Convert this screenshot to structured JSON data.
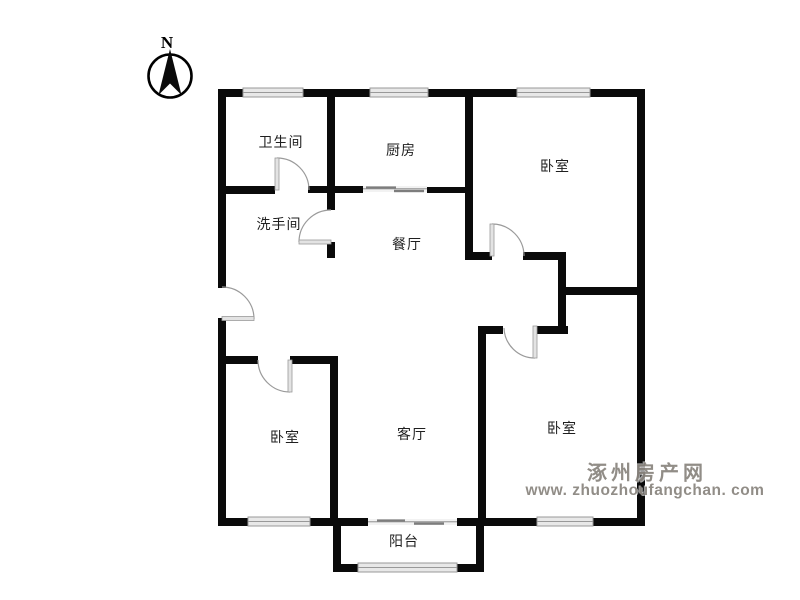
{
  "compass": {
    "label": "N"
  },
  "rooms": [
    {
      "name": "bathroom",
      "label": "卫生间"
    },
    {
      "name": "kitchen",
      "label": "厨房"
    },
    {
      "name": "bedroom-top-right",
      "label": "卧室"
    },
    {
      "name": "washroom",
      "label": "洗手间"
    },
    {
      "name": "dining-room",
      "label": "餐厅"
    },
    {
      "name": "bedroom-bottom-left",
      "label": "卧室"
    },
    {
      "name": "living-room",
      "label": "客厅"
    },
    {
      "name": "bedroom-bottom-right",
      "label": "卧室"
    },
    {
      "name": "balcony",
      "label": "阳台"
    }
  ],
  "watermark": {
    "site_name": "涿州房产网",
    "site_url": "www. zhuozhoufangchan. com"
  },
  "colors": {
    "wall": "#0a0a0a",
    "window_fill": "#e8e8e8",
    "window_line": "#999999",
    "door": "#9a9a9a",
    "door_leaf_fill": "#e3e3e3",
    "watermark": "#8c8781",
    "label_text": "#1f1f1f",
    "background": "#ffffff"
  }
}
